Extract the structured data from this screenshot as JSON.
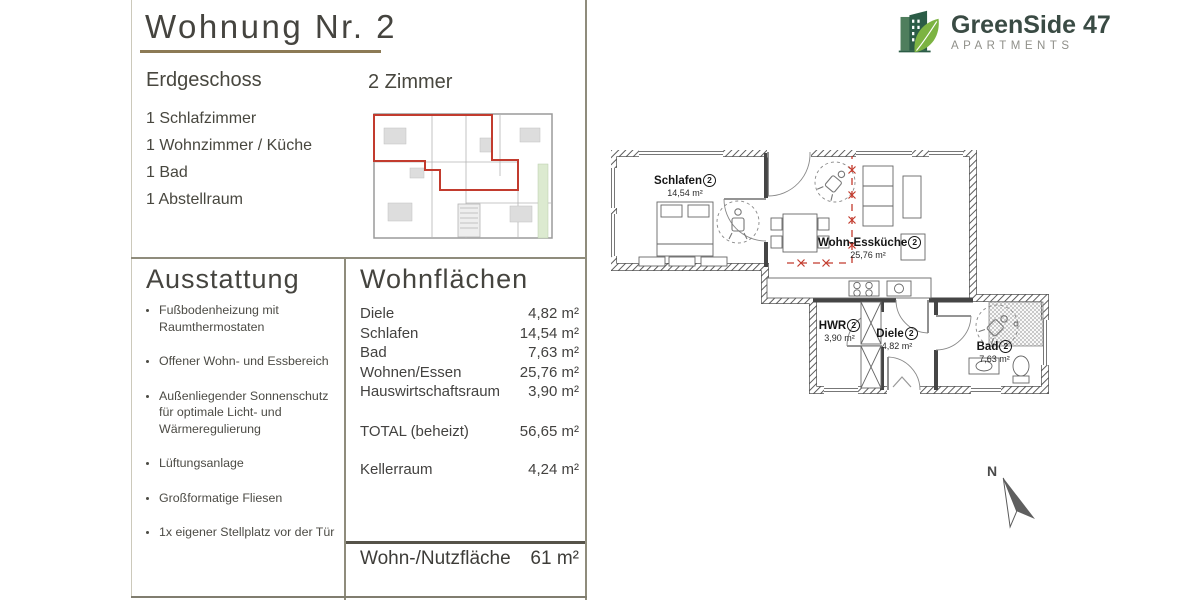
{
  "title": "Wohnung Nr. 2",
  "floor": "Erdgeschoss",
  "rooms_count": "2 Zimmer",
  "room_list": [
    "1 Schlafzimmer",
    "1 Wohnzimmer / Küche",
    "1 Bad",
    "1 Abstellraum"
  ],
  "ausstattung": {
    "heading": "Ausstattung",
    "items": [
      "Fußbodenheizung mit Raumthermostaten",
      "Offener Wohn- und Essbereich",
      "Außenliegender Sonnenschutz für optimale Licht- und Wärmeregulierung",
      "Lüftungsanlage",
      "Großformatige Fliesen",
      "1x eigener Stellplatz vor der Tür"
    ]
  },
  "wohnflaechen": {
    "heading": "Wohnflächen",
    "rows": [
      {
        "label": "Diele",
        "value": "4,82 m²"
      },
      {
        "label": "Schlafen",
        "value": "14,54 m²"
      },
      {
        "label": "Bad",
        "value": "7,63 m²"
      },
      {
        "label": "Wohnen/Essen",
        "value": "25,76 m²"
      },
      {
        "label": "Hauswirtschaftsraum",
        "value": "3,90 m²"
      }
    ],
    "total": {
      "label": "TOTAL (beheizt)",
      "value": "56,65 m²"
    },
    "keller": {
      "label": "Kellerraum",
      "value": "4,24 m²"
    },
    "summary": {
      "label": "Wohn-/Nutzfläche",
      "value": "61 m²"
    }
  },
  "logo": {
    "name": "GreenSide 47",
    "subtitle": "APARTMENTS"
  },
  "floorplan": {
    "rooms": [
      {
        "name": "Schlafen",
        "num": "2",
        "area": "14,54 m²"
      },
      {
        "name": "Wohn-Essküche",
        "num": "2",
        "area": "25,76 m²"
      },
      {
        "name": "HWR",
        "num": "2",
        "area": "3,90 m²"
      },
      {
        "name": "Diele",
        "num": "2",
        "area": "4,82 m²"
      },
      {
        "name": "Bad",
        "num": "2",
        "area": "7,63 m²"
      }
    ],
    "north_label": "N"
  },
  "colors": {
    "accent_red": "#c23b2e",
    "underline_gold": "#8c7a55",
    "divider_olive": "#8f8c7c",
    "logo_dark_green": "#2b5c46",
    "logo_back_green": "#4f7e5d",
    "logo_leaf_green": "#7cb342"
  }
}
